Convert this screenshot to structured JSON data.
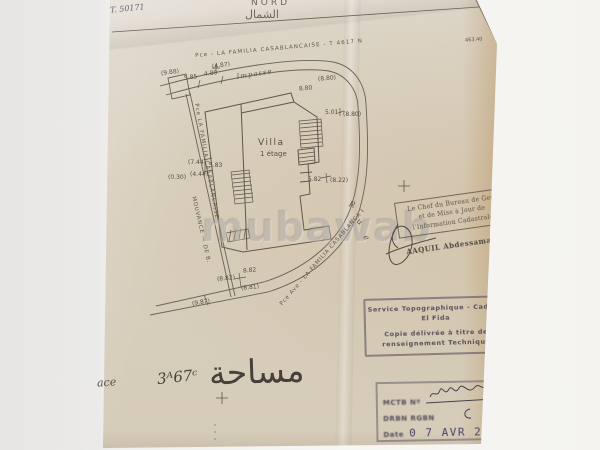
{
  "colors": {
    "paper": "#d9cfbd",
    "ink": "#5d564b",
    "stamp_ink": "#4c4757",
    "date_ink": "#474466",
    "watermark": "#726a62"
  },
  "paper": {
    "ref_handwritten": "T. 50171",
    "north_label": "NORD",
    "north_arabic": "الشمال",
    "corner_number": "463.40",
    "area_arabic": "مساحة",
    "area_value": "3ᴬ67ᶜ",
    "area_partial_left": "ace",
    "bottom_marks": "°°°"
  },
  "plan": {
    "villa_label": "Villa",
    "villa_floors": "1 étage",
    "impasse_label": "Impasse",
    "top_boundary_label": "Pce - LA FAMILIA CASABLANCAISE - T 4617 N",
    "left_boundary_label": "Pce LA FAMILIA CASABLANCAISE",
    "mouvance_label": "MOUVANCE — DE B.",
    "road_label": "Pce Ave - LA FAMILIA CASABLANCA I",
    "rue_letters": [
      {
        "ch": "R",
        "x": 349,
        "y": 200,
        "r": 20
      },
      {
        "ch": "u",
        "x": 357,
        "y": 217,
        "r": 36
      },
      {
        "ch": "e",
        "x": 364,
        "y": 233,
        "r": 50
      }
    ],
    "dimensions": [
      {
        "t": "(9.88)",
        "x": 161,
        "y": 69,
        "r": -8
      },
      {
        "t": "5.85",
        "x": 184,
        "y": 74,
        "r": -8
      },
      {
        "t": "4.80",
        "x": 204,
        "y": 70,
        "r": -8
      },
      {
        "t": "(4.87)",
        "x": 212,
        "y": 62,
        "r": -8
      },
      {
        "t": "(8.80)",
        "x": 318,
        "y": 75,
        "r": -5
      },
      {
        "t": "8.80",
        "x": 299,
        "y": 85,
        "r": -5
      },
      {
        "t": "5.01",
        "x": 325,
        "y": 109,
        "r": 0
      },
      {
        "t": "(8.80)",
        "x": 343,
        "y": 111,
        "r": 0
      },
      {
        "t": "(7.44)",
        "x": 188,
        "y": 159,
        "r": 0
      },
      {
        "t": "5.83",
        "x": 209,
        "y": 162,
        "r": 0
      },
      {
        "t": "(0.30)",
        "x": 168,
        "y": 174,
        "r": 0
      },
      {
        "t": "(4.44)",
        "x": 190,
        "y": 171,
        "r": 0
      },
      {
        "t": "5.82",
        "x": 308,
        "y": 176,
        "r": 0
      },
      {
        "t": "(8.22)",
        "x": 330,
        "y": 177,
        "r": 0
      },
      {
        "t": "8.82",
        "x": 243,
        "y": 267,
        "r": -6
      },
      {
        "t": "(8.82)",
        "x": 217,
        "y": 275,
        "r": -6
      },
      {
        "t": "(8.81)",
        "x": 241,
        "y": 284,
        "r": -6
      },
      {
        "t": "(9.87)",
        "x": 192,
        "y": 299,
        "r": -10
      }
    ]
  },
  "stamps": {
    "chef_bureau": {
      "lines": [
        "Le Chef du Bureau de Ges",
        "et de Mise à Jour de",
        "l'Information Cadastrale"
      ],
      "signature_name": "AAQUIL Abdessamad"
    },
    "service_topo": {
      "lines": [
        "Service Topographique - Cad - B",
        "El Fida",
        "Copie délivrée à titre de",
        "renseignement Technique"
      ]
    },
    "date_stamp": {
      "row1_label": "MCTB Nº",
      "row2_label": "DRBN RGBN",
      "date_label": "Date",
      "date_value": "0 7 AVR 2014"
    }
  },
  "watermark": {
    "text": "mubawab"
  }
}
